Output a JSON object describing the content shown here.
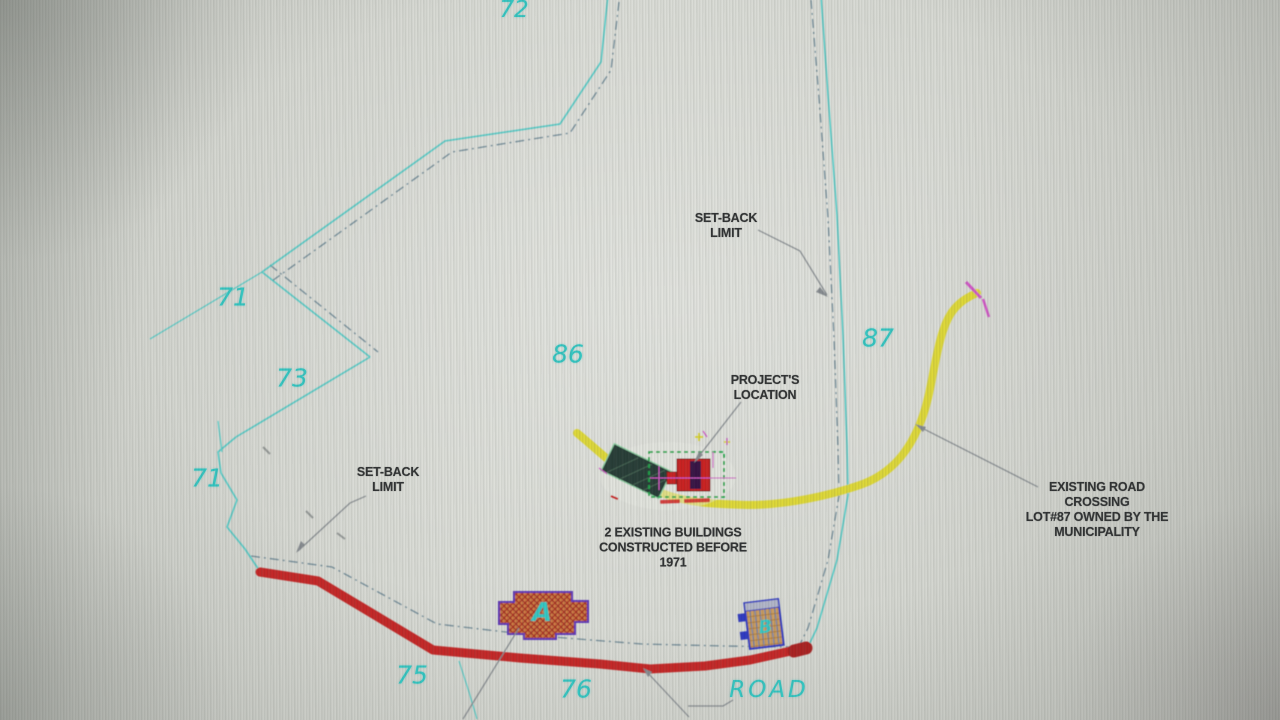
{
  "canvas": {
    "width": 1280,
    "height": 720,
    "description": "CAD site plan drawing photographed on a monitor"
  },
  "colors": {
    "boundary_cyan": "#3bc6c2",
    "setback_dash": "#64808f",
    "road_red": "#c22222",
    "road_yellow": "#ddd72b",
    "dashed_box_green": "#1fa84a",
    "magenta": "#cf52c4",
    "label_cyan": "#2fc4c0",
    "annotation_black": "#2b2d2e"
  },
  "lots": {
    "top": "72",
    "upper_left": "71",
    "left": "73",
    "lower_left": "71",
    "center": "86",
    "right": "87",
    "bottom_left": "75",
    "bottom_center": "76"
  },
  "road": {
    "label": "ROAD"
  },
  "buildings": {
    "a": "A",
    "b": "B"
  },
  "annotations": {
    "setback_right": [
      "SET-BACK",
      "LIMIT"
    ],
    "setback_left": [
      "SET-BACK",
      "LIMIT"
    ],
    "project_location": [
      "PROJECT'S",
      "LOCATION"
    ],
    "existing_buildings": [
      "2 EXISTING BUILDINGS",
      "CONSTRUCTED BEFORE",
      "1971"
    ],
    "existing_road": [
      "EXISTING ROAD",
      "CROSSING",
      "LOT#87 OWNED BY THE",
      "MUNICIPALITY"
    ]
  }
}
